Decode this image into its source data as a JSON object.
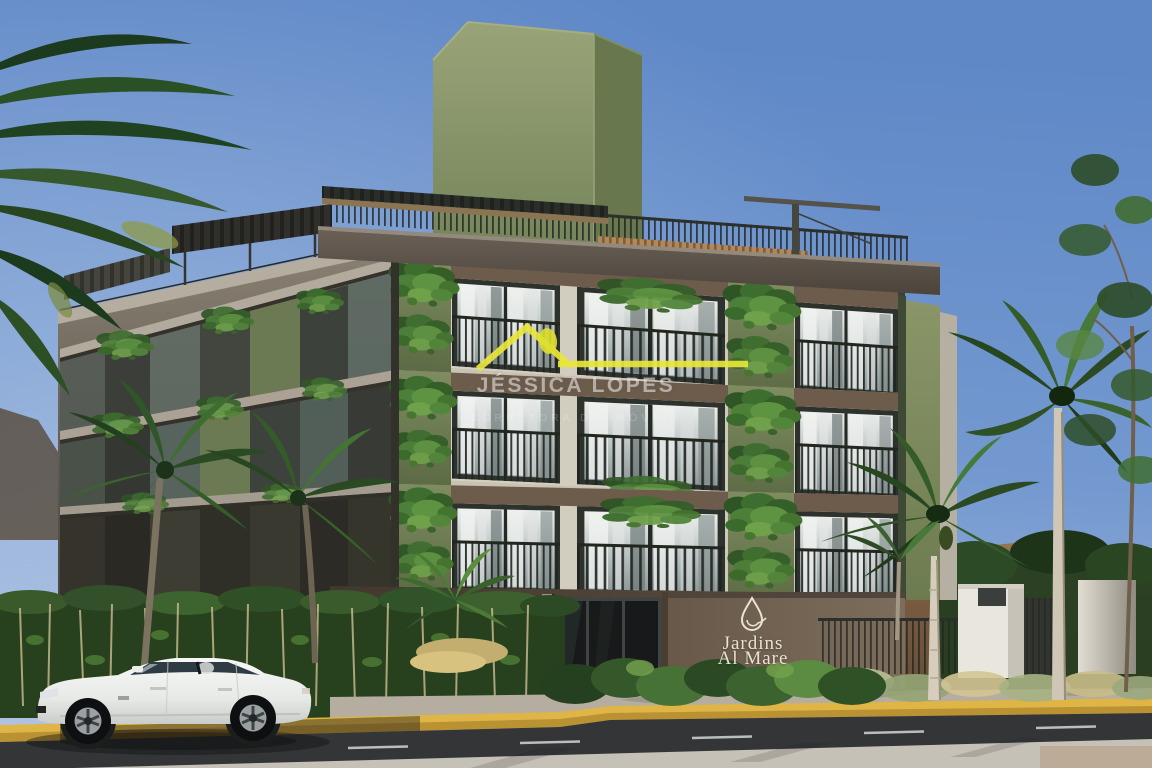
{
  "watermark": {
    "brand": "JÉSSICA LOPES",
    "tagline": "CORRETORA DE IMÓVEIS",
    "logo_icon": "house-roof-icon",
    "accent_color": "#e9e63a"
  },
  "building": {
    "sign_name_line1": "Jardins",
    "sign_name_line2": "Al Mare",
    "sign_logo_icon": "water-drop-leaf-icon",
    "sign_text_color": "#eae3d2"
  },
  "palette": {
    "sky_top": "#5f88c7",
    "sky_low": "#a9bddd",
    "tower_green": "#8b9769",
    "facade_cream": "#d8d3c5",
    "entrance_brown": "#57493c",
    "curb_yellow": "#dfb546",
    "asphalt_gray": "#333537",
    "foliage_dark": "#2d4a28",
    "car_white": "#eff0ee"
  }
}
